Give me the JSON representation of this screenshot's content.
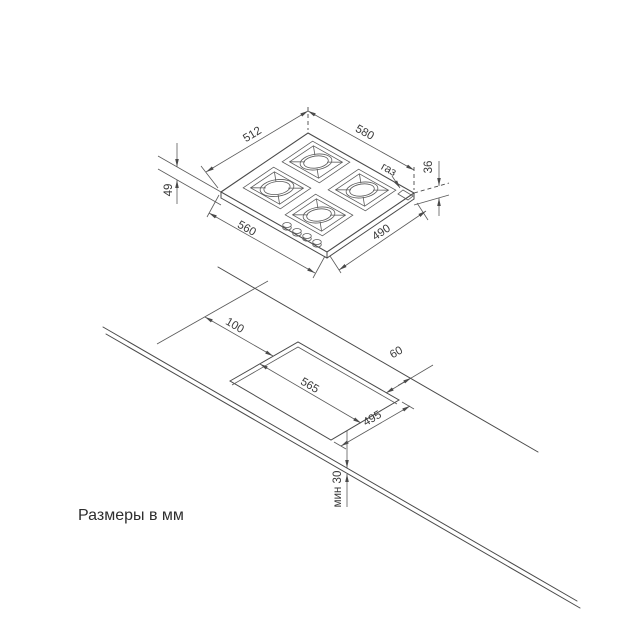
{
  "caption": "Размеры в мм",
  "top_view": {
    "description": "hob-isometric-view",
    "dims": {
      "back_left_edge": "512",
      "back_right_edge": "580",
      "front_left_edge": "560",
      "front_right_edge": "490",
      "height_left": "49",
      "height_right": "36",
      "gas_label": "газ"
    }
  },
  "bottom_view": {
    "description": "worktop-cutout-isometric-view",
    "dims": {
      "left_offset": "100",
      "cutout_length": "565",
      "back_offset": "60",
      "cutout_width": "495",
      "min_thickness": "мин 30"
    }
  },
  "colors": {
    "line": "#4a4a4a",
    "text": "#3a3a3a",
    "background": "#ffffff"
  }
}
